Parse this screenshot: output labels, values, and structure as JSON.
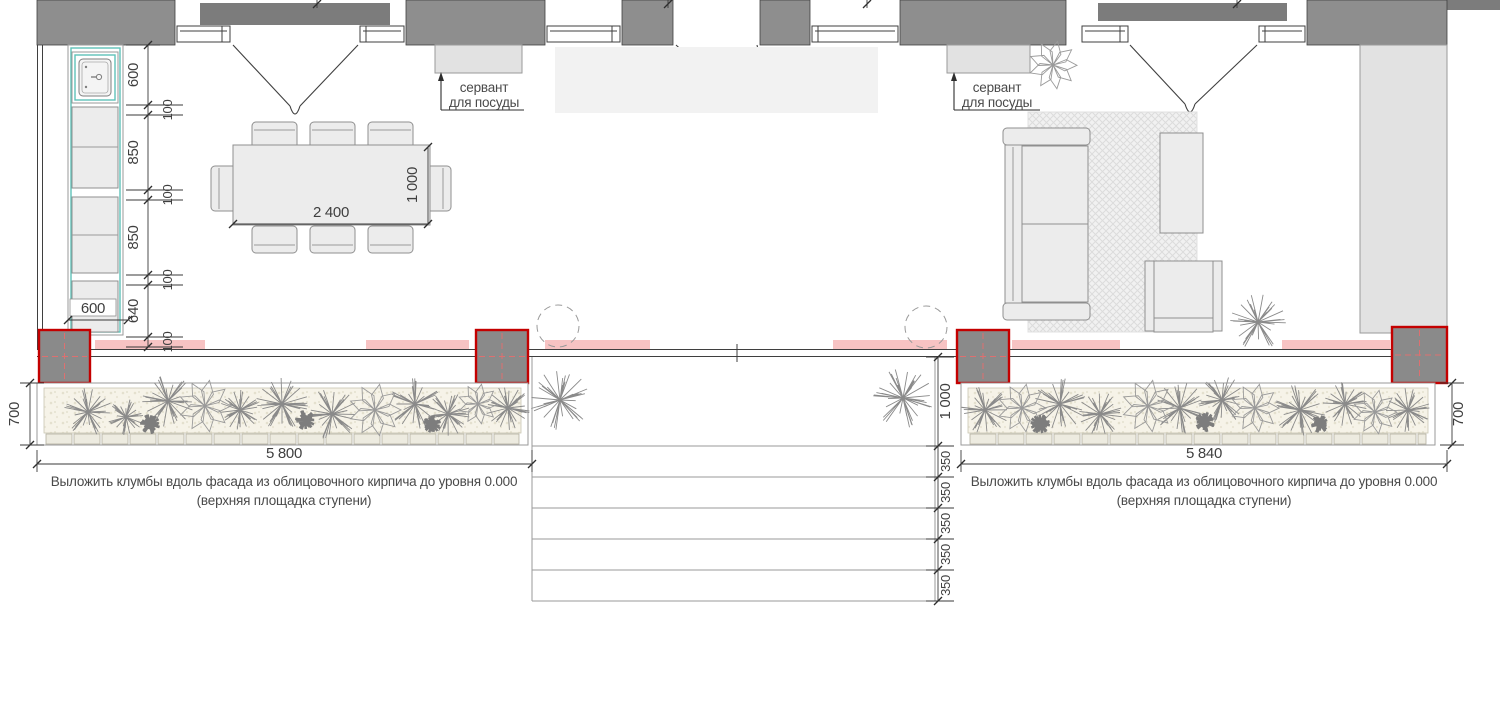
{
  "sideboard_left": {
    "line1": "сервант",
    "line2": "для посуды"
  },
  "sideboard_right": {
    "line1": "сервант",
    "line2": "для посуды"
  },
  "notes": {
    "left_line1": "Выложить клумбы вдоль фасада из облицовочного кирпича до уровня 0.000",
    "left_line2": "(верхняя площадка ступени)",
    "right_line1": "Выложить клумбы вдоль фасада из облицовочного кирпича до уровня 0.000",
    "right_line2": "(верхняя площадка ступени)"
  },
  "dims": {
    "counter_segments": [
      "600",
      "850",
      "850",
      "640"
    ],
    "counter_offsets": [
      "100",
      "100",
      "100",
      "100"
    ],
    "counter_width": "600",
    "table_length": "2 400",
    "table_width": "1 000",
    "bed_left_length": "5 800",
    "bed_right_length": "5 840",
    "bed_left_depth": "700",
    "bed_right_depth": "700",
    "steps_landing": "1 000",
    "step_treads": [
      "350",
      "350",
      "350",
      "350",
      "350"
    ]
  },
  "colors": {
    "wall": "#8e8e8e",
    "canopy": "#7c7c7c",
    "column_fill": "#8a8a8a",
    "column_border": "#c40000",
    "accent_teal": "#5fc2b8",
    "radiator_pink": "#f6bcbc",
    "plant": "#8a8a8a",
    "bed_fill": "#f6f3e8"
  }
}
